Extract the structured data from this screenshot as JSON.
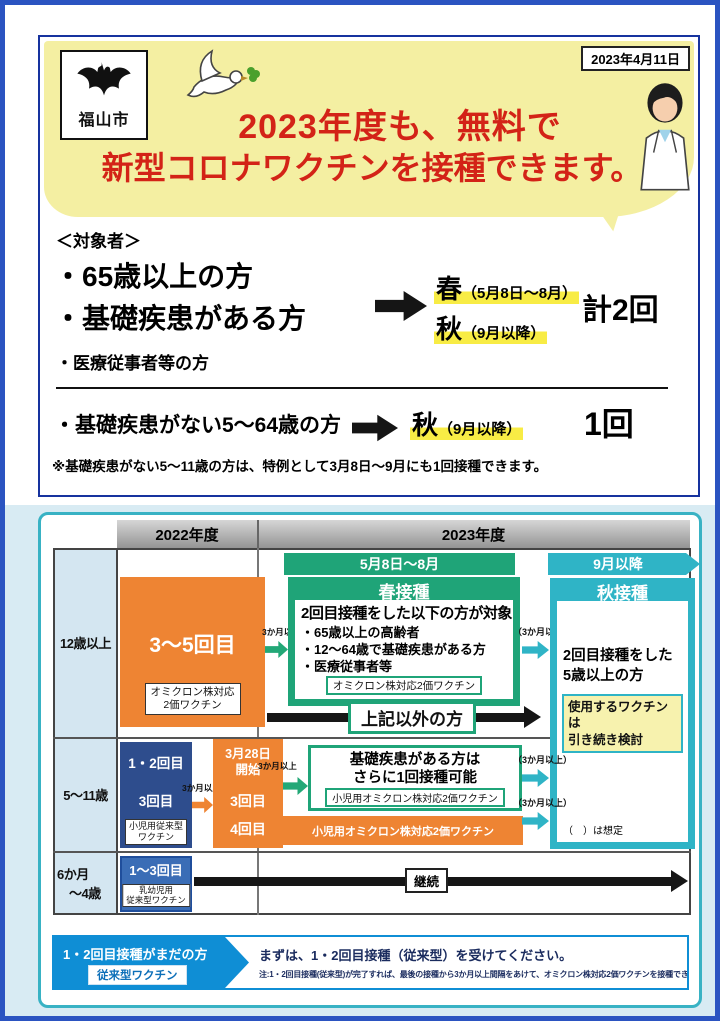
{
  "colors": {
    "frame_blue": "#2b54c1",
    "panel_border_navy": "#17339e",
    "panel_border_teal": "#38b2c4",
    "title_red": "#d32317",
    "bubble_yellow": "#f4efa2",
    "highlight_yellow": "#f8ec45",
    "green": "#1fa478",
    "teal": "#2fb4c6",
    "orange": "#ee8433",
    "navy": "#2e4d8d",
    "infant_blue": "#3a6db6",
    "footer_blue": "#0f8ed5",
    "label_col_blue": "#d4e6f1",
    "note_yellow": "#f7f2ae"
  },
  "header": {
    "date": "2023年4月11日",
    "city_name": "福山市",
    "title_line1": "2023年度も、無料で",
    "title_line2": "新型コロナワクチンを接種できます。"
  },
  "eligibility": {
    "heading": "＜対象者＞",
    "group1_item1": "・65歳以上の方",
    "group1_item2": "・基礎疾患がある方",
    "spring": "春",
    "spring_period": "（5月8日～8月）",
    "autumn": "秋",
    "autumn_period": "（9月以降）",
    "group1_total": "計2回",
    "group1_item3": "・医療従事者等の方",
    "group2_item": "・基礎疾患がない5～64歳の方",
    "group2_autumn": "秋",
    "group2_autumn_period": "（9月以降）",
    "group2_total": "1回",
    "note": "※基礎疾患がない5～11歳の方は、特例として3月8日～9月にも1回接種できます。"
  },
  "timeline": {
    "year_2022": "2022年度",
    "year_2023": "2023年度",
    "spring_period_bar": "5月8日～8月",
    "autumn_period_bar": "9月以降",
    "interval_plain": "3か月以上",
    "interval_paren": "（3か月以上）",
    "row_labels": {
      "r1": "12歳以上",
      "r2": "5～11歳",
      "r3a": "6か月",
      "r3b": "～4歳"
    },
    "age12": {
      "box_label": "3～5回目",
      "box_tag_line1": "オミクロン株対応",
      "box_tag_line2": "2価ワクチン",
      "spring_title": "春接種",
      "spring_heading": "2回目接種をした以下の方が対象",
      "bullets": [
        "・65歳以上の高齢者",
        "・12～64歳で基礎疾患がある方",
        "・医療従事者等"
      ],
      "spring_tag": "オミクロン株対応2価ワクチン",
      "others_label": "上記以外の方"
    },
    "autumn": {
      "title": "秋接種",
      "target_line1": "2回目接種をした",
      "target_line2": "5歳以上の方",
      "vaccine_note_line1": "使用するワクチンは",
      "vaccine_note_line2": "引き続き検討",
      "assumption_note": "（　）は想定"
    },
    "age5to11": {
      "box1_line1": "1・2回目",
      "box1_line2": "3回目",
      "box1_tag_line1": "小児用従来型",
      "box1_tag_line2": "ワクチン",
      "box2_line1": "3月28日",
      "box2_line2": "開始",
      "box2_line3": "3回目",
      "box2_line4": "4回目",
      "cond_line1": "基礎疾患がある方は",
      "cond_line2": "さらに1回接種可能",
      "cond_tag": "小児用オミクロン株対応2価ワクチン",
      "bar_label": "小児用オミクロン株対応2価ワクチン"
    },
    "age0to4": {
      "box_label": "1～3回目",
      "box_tag_line1": "乳幼児用",
      "box_tag_line2": "従来型ワクチン",
      "continue_label": "継続"
    },
    "footer": {
      "left_title": "1・2回目接種がまだの方",
      "left_tag": "従来型ワクチン",
      "right_line1": "まずは、1・2回目接種（従来型）を受けてください。",
      "right_line2": "注:1・2回目接種(従来型)が完了すれば、最後の接種から3か月以上間隔をあけて、オミクロン株対応2価ワクチンを接種できます。"
    }
  }
}
